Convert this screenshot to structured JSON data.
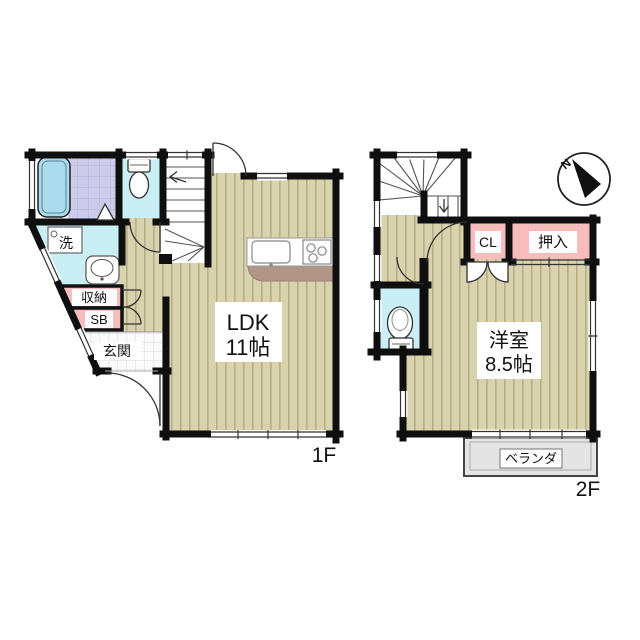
{
  "floor1": {
    "floor_label": "1F",
    "ldk_name": "LDK",
    "ldk_size": "11帖",
    "entrance_label": "玄関",
    "storage_label": "収納",
    "shoebox_label": "SB",
    "laundry_label": "洗"
  },
  "floor2": {
    "floor_label": "2F",
    "room_name": "洋室",
    "room_size": "8.5帖",
    "closet_label": "CL",
    "oshiire_label": "押入",
    "veranda_label": "ベランダ",
    "compass_north": "N"
  },
  "colors": {
    "wall": "#0f0f0f",
    "wood_floor": "#d8d3ad",
    "wet_room_cyan": "#c9eff5",
    "closet_pink": "#f7bdbd",
    "bath_tile_purple": "#ccccea",
    "veranda_gray": "#e4e4e4",
    "kitchen_counter_brown": "#b29488",
    "bathtub_blue": "#aadcee"
  }
}
